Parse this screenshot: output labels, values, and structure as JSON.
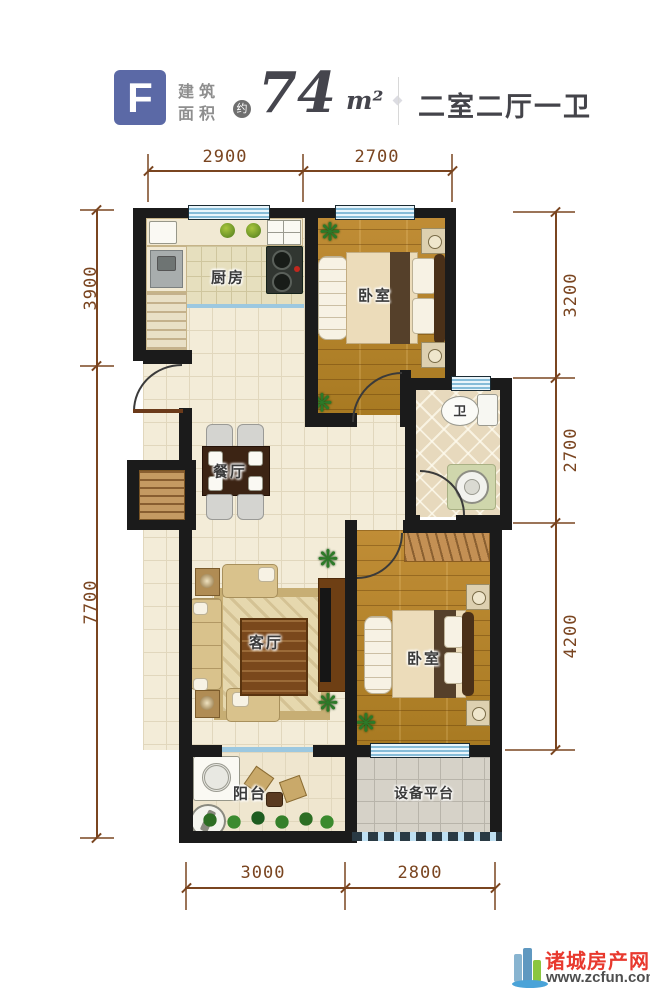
{
  "header": {
    "unit_letter": "F",
    "area_label_top": "建筑",
    "area_label_bottom": "面积",
    "approx_badge": "约",
    "area_value": "74",
    "area_unit": "m²",
    "layout_summary": "二室二厅一卫"
  },
  "rooms": {
    "kitchen": "厨房",
    "bedroom_top": "卧室",
    "bathroom": "卫",
    "dining": "餐厅",
    "living": "客厅",
    "bedroom_bottom": "卧室",
    "balcony": "阳台",
    "equipment_platform": "设备平台"
  },
  "dimensions": {
    "top": [
      "2900",
      "2700"
    ],
    "left": [
      "3900",
      "7700"
    ],
    "right": [
      "3200",
      "2700",
      "4200"
    ],
    "bottom": [
      "3000",
      "2800"
    ]
  },
  "watermark": {
    "site_name": "诸城房产网",
    "site_url": "www.zcfun.com"
  },
  "icons": {
    "plant": "❋"
  },
  "colors": {
    "unit_badge_blue": "#5b69a6",
    "dimension_brown": "#7a4520",
    "wall_black": "#1b1b1b",
    "window_blue": "#bfe0f2",
    "brand_red": "#e8392e"
  }
}
